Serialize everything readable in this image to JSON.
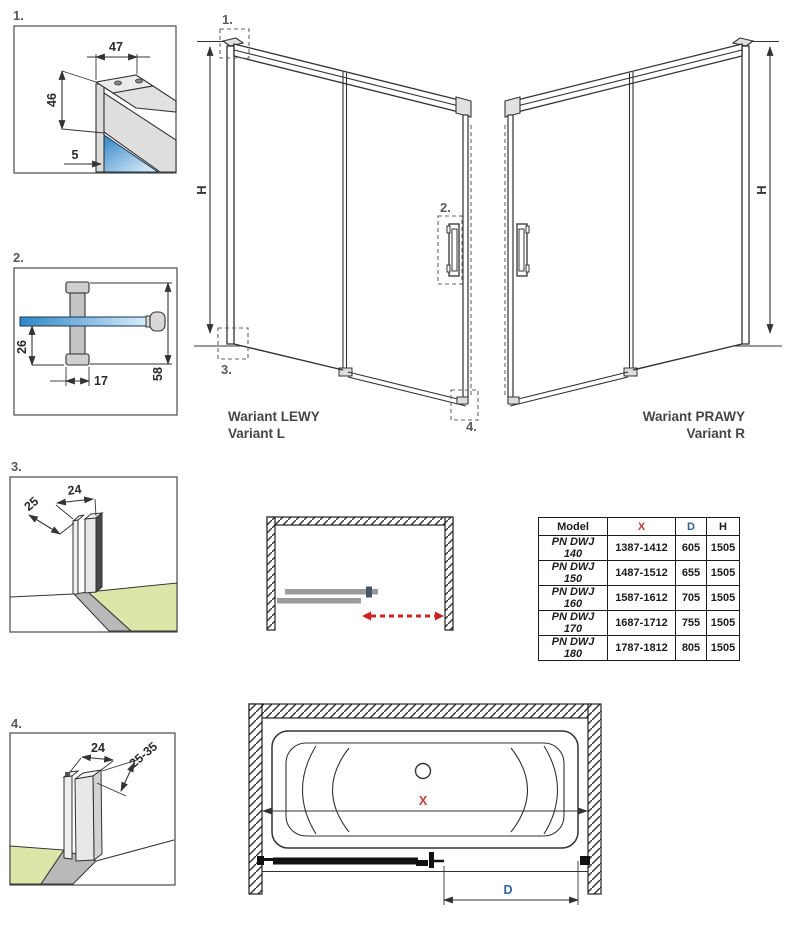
{
  "colors": {
    "line": "#333333",
    "glass_blue": "#2e86c8",
    "floor_green": "#dde6a9",
    "dim_red": "#c23b3b",
    "dim_blue": "#2f6298",
    "slide_arrow_red": "#cc2222",
    "panel_gray": "#9a9a9a",
    "handle_dark": "#45566a"
  },
  "details": {
    "d1": {
      "label": "1.",
      "dims": {
        "top_width": "47",
        "front_height": "46",
        "glass_inset": "5"
      }
    },
    "d2": {
      "label": "2.",
      "dims": {
        "below_glass": "26",
        "grip_width": "17",
        "total_height": "58"
      }
    },
    "d3": {
      "label": "3.",
      "dims": {
        "depth": "25",
        "width": "24"
      }
    },
    "d4": {
      "label": "4.",
      "dims": {
        "width": "24",
        "adjust_range": "25-35"
      }
    }
  },
  "variants": {
    "left": {
      "title": "Wariant LEWY",
      "subtitle": "Variant L",
      "height_label": "H",
      "callouts": {
        "c1": "1.",
        "c2": "2.",
        "c3": "3.",
        "c4": "4."
      }
    },
    "right": {
      "title": "Wariant PRAWY",
      "subtitle": "Variant R",
      "height_label": "H"
    }
  },
  "size_table": {
    "headers": {
      "model": "Model",
      "x": "X",
      "d": "D",
      "h": "H"
    },
    "rows": [
      {
        "model": "PN DWJ 140",
        "x": "1387-1412",
        "d": "605",
        "h": "1505"
      },
      {
        "model": "PN DWJ 150",
        "x": "1487-1512",
        "d": "655",
        "h": "1505"
      },
      {
        "model": "PN DWJ 160",
        "x": "1587-1612",
        "d": "705",
        "h": "1505"
      },
      {
        "model": "PN DWJ 170",
        "x": "1687-1712",
        "d": "755",
        "h": "1505"
      },
      {
        "model": "PN DWJ 180",
        "x": "1787-1812",
        "d": "805",
        "h": "1505"
      }
    ]
  },
  "bath_view": {
    "x_label": "X",
    "d_label": "D"
  }
}
